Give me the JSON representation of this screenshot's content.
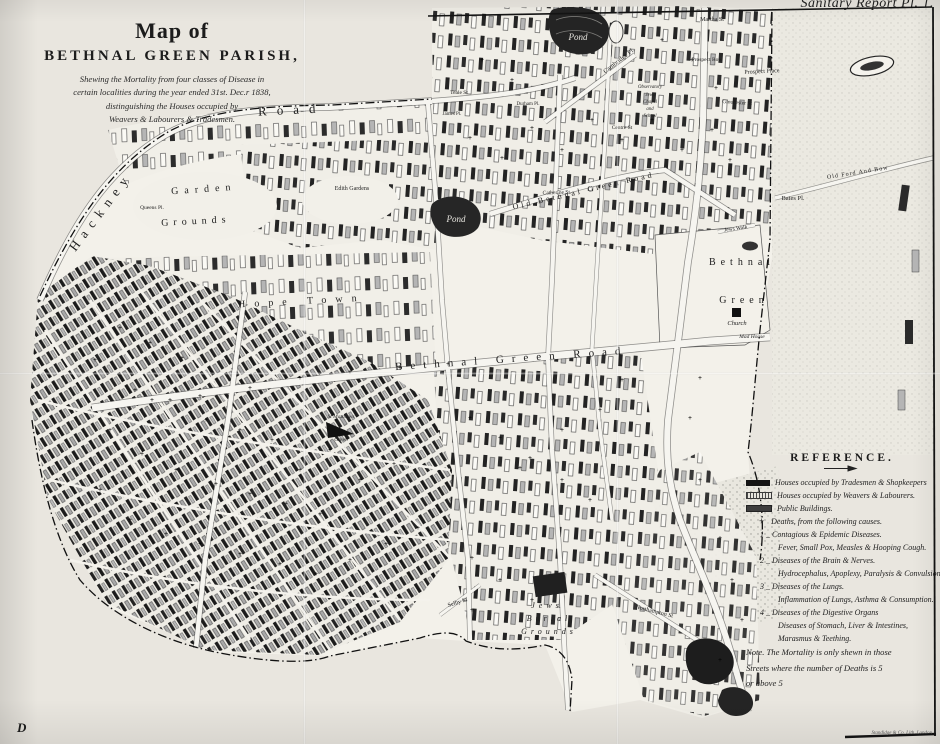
{
  "plate_label": "Sanitary Report Pl. 1.",
  "plate_letter": "D",
  "imprint": "Standidge & Co. Lith. London",
  "title_block": {
    "line1": "Map of",
    "line2": "BETHNAL GREEN PARISH,",
    "subtitle": [
      "Shewing the Mortality from four classes of Disease in",
      "certain localities during the year ended 31st. Dec.r 1838,",
      "distinguishing the Houses occupied by",
      "Weavers & Labourers & Tradesmen."
    ]
  },
  "reference": {
    "heading": "REFERENCE.",
    "rows": [
      {
        "type": "swatch",
        "swatch": "tradesmen",
        "text": "Houses occupied by Tradesmen & Shopkeepers"
      },
      {
        "type": "swatch",
        "swatch": "weavers",
        "text": "Houses occupied by Weavers & Labourers."
      },
      {
        "type": "swatch",
        "swatch": "public",
        "text": "Public Buildings."
      },
      {
        "type": "plus",
        "text": "Deaths, from the following causes."
      },
      {
        "type": "cause",
        "text": "1 _ Contagious & Epidemic Diseases."
      },
      {
        "type": "detail",
        "text": "Fever, Small Pox, Measles & Hooping Cough."
      },
      {
        "type": "cause",
        "text": "2 _ Diseases of the Brain & Nerves."
      },
      {
        "type": "detail",
        "text": "Hydrocephalus, Apoplexy, Paralysis & Convulsions."
      },
      {
        "type": "cause",
        "text": "3 _ Diseases of the Lungs."
      },
      {
        "type": "detail",
        "text": "Inflammation of Lungs, Asthma & Consumption."
      },
      {
        "type": "cause",
        "text": "4 _ Diseases of the Digestive Organs"
      },
      {
        "type": "detail",
        "text": "Diseases of Stomach, Liver & Intestines,"
      },
      {
        "type": "detail",
        "text": "Marasmus & Teething."
      },
      {
        "type": "note",
        "text": "Note. The Mortality is only shewn in those"
      },
      {
        "type": "note",
        "text": "Streets where the number of Deaths is 5"
      },
      {
        "type": "note",
        "text": "or above 5"
      }
    ]
  },
  "map": {
    "labels": [
      {
        "t": "Hackney",
        "x": 104,
        "y": 214,
        "fs": 13,
        "rot": -53,
        "ls": 7
      },
      {
        "t": "Road",
        "x": 292,
        "y": 114,
        "fs": 13,
        "rot": -3,
        "ls": 10
      },
      {
        "t": "Garden",
        "x": 204,
        "y": 192,
        "fs": 10,
        "rot": -4,
        "ls": 6
      },
      {
        "t": "Grounds",
        "x": 196,
        "y": 224,
        "fs": 10,
        "rot": -3,
        "ls": 5
      },
      {
        "t": "Queens Pl.",
        "x": 152,
        "y": 209,
        "fs": 5.5
      },
      {
        "t": "Edith Gardens",
        "x": 352,
        "y": 190,
        "fs": 6
      },
      {
        "t": "Hope Town",
        "x": 302,
        "y": 304,
        "fs": 10,
        "rot": -3,
        "ls": 9
      },
      {
        "t": "Old Bethnal Green Road",
        "x": 584,
        "y": 193,
        "fs": 8,
        "rot": -13,
        "ls": 3
      },
      {
        "t": "Bethnal Green Road",
        "x": 512,
        "y": 362,
        "fs": 11,
        "rot": -4,
        "ls": 8
      },
      {
        "t": "Bethnal",
        "x": 742,
        "y": 265,
        "fs": 10,
        "ls": 5
      },
      {
        "t": "Green",
        "x": 744,
        "y": 303,
        "fs": 10,
        "ls": 5
      },
      {
        "t": "Church",
        "x": 737,
        "y": 325,
        "fs": 6.5,
        "it": 1
      },
      {
        "t": "Mad House",
        "x": 752,
        "y": 338,
        "fs": 5.5,
        "it": 1
      },
      {
        "t": "Jews Walk",
        "x": 736,
        "y": 230,
        "fs": 5.5,
        "rot": -8
      },
      {
        "t": "Pond",
        "x": 578,
        "y": 40,
        "fs": 9,
        "it": 1,
        "col": "#e8e6e0"
      },
      {
        "t": "Pond",
        "x": 456,
        "y": 222,
        "fs": 9,
        "it": 1,
        "col": "#e8e6e0"
      },
      {
        "t": "Martha St",
        "x": 712,
        "y": 21,
        "fs": 6
      },
      {
        "t": "Prospect Row",
        "x": 707,
        "y": 61,
        "fs": 5.5
      },
      {
        "t": "Prospect Place",
        "x": 762,
        "y": 73,
        "fs": 6,
        "rot": -3
      },
      {
        "t": "Cambridge Pl.",
        "x": 620,
        "y": 62,
        "fs": 6.5,
        "rot": -38
      },
      {
        "t": "Gloucester St",
        "x": 737,
        "y": 104,
        "fs": 5.5,
        "rot": 4
      },
      {
        "t": "Observatory",
        "x": 650,
        "y": 88,
        "fs": 4.8,
        "it": 1
      },
      {
        "t": "Jews",
        "x": 650,
        "y": 96,
        "fs": 4.8,
        "it": 1
      },
      {
        "t": "Chapel",
        "x": 650,
        "y": 103,
        "fs": 4.8,
        "it": 1
      },
      {
        "t": "and",
        "x": 650,
        "y": 110,
        "fs": 4.8,
        "it": 1
      },
      {
        "t": "School",
        "x": 650,
        "y": 117,
        "fs": 4.8,
        "it": 1
      },
      {
        "t": "Bates Pl.",
        "x": 793,
        "y": 200,
        "fs": 6.5
      },
      {
        "t": "Old Ford And Bow",
        "x": 858,
        "y": 174,
        "fs": 6,
        "rot": -9,
        "ls": 1
      },
      {
        "t": "Centre St",
        "x": 622,
        "y": 129,
        "fs": 5.5
      },
      {
        "t": "Teale St",
        "x": 459,
        "y": 94,
        "fs": 5.5
      },
      {
        "t": "Durham Pl.",
        "x": 528,
        "y": 105,
        "fs": 5
      },
      {
        "t": "James Pl.",
        "x": 452,
        "y": 115,
        "fs": 5
      },
      {
        "t": "Catherine St.",
        "x": 557,
        "y": 194,
        "fs": 5.5,
        "rot": -2
      },
      {
        "t": "St Matthews",
        "x": 341,
        "y": 418,
        "fs": 5.5,
        "it": 1
      },
      {
        "t": "Green",
        "x": 341,
        "y": 441,
        "fs": 5.5,
        "it": 1
      },
      {
        "t": "Jews",
        "x": 547,
        "y": 608,
        "fs": 8,
        "ls": 4,
        "it": 1
      },
      {
        "t": "Burial",
        "x": 549,
        "y": 621,
        "fs": 8,
        "ls": 4,
        "it": 1
      },
      {
        "t": "Grounds",
        "x": 549,
        "y": 634,
        "fs": 8,
        "ls": 4,
        "it": 1
      },
      {
        "t": "Northampton St",
        "x": 654,
        "y": 613,
        "fs": 6,
        "rot": 14
      },
      {
        "t": "Selby St",
        "x": 458,
        "y": 604,
        "fs": 6,
        "rot": -18
      }
    ],
    "death_markers": [
      [
        120,
        330
      ],
      [
        150,
        345
      ],
      [
        182,
        360
      ],
      [
        212,
        376
      ],
      [
        95,
        362
      ],
      [
        135,
        392
      ],
      [
        170,
        402
      ],
      [
        206,
        422
      ],
      [
        240,
        432
      ],
      [
        272,
        442
      ],
      [
        110,
        432
      ],
      [
        142,
        456
      ],
      [
        176,
        472
      ],
      [
        216,
        486
      ],
      [
        250,
        496
      ],
      [
        286,
        506
      ],
      [
        320,
        516
      ],
      [
        100,
        492
      ],
      [
        130,
        522
      ],
      [
        166,
        536
      ],
      [
        200,
        546
      ],
      [
        240,
        556
      ],
      [
        280,
        566
      ],
      [
        316,
        576
      ],
      [
        350,
        562
      ],
      [
        386,
        546
      ],
      [
        418,
        530
      ],
      [
        360,
        482
      ],
      [
        394,
        466
      ],
      [
        330,
        452
      ],
      [
        300,
        472
      ],
      [
        250,
        390
      ],
      [
        200,
        398
      ],
      [
        152,
        402
      ],
      [
        300,
        380
      ],
      [
        350,
        374
      ],
      [
        400,
        370
      ],
      [
        448,
        366
      ],
      [
        470,
        420
      ],
      [
        500,
        440
      ],
      [
        530,
        460
      ],
      [
        562,
        482
      ],
      [
        590,
        502
      ],
      [
        472,
        560
      ],
      [
        500,
        582
      ],
      [
        532,
        602
      ],
      [
        472,
        612
      ],
      [
        520,
        470
      ],
      [
        562,
        432
      ],
      [
        600,
        412
      ],
      [
        622,
        382
      ],
      [
        470,
        140
      ],
      [
        502,
        160
      ],
      [
        532,
        130
      ],
      [
        562,
        152
      ],
      [
        592,
        122
      ],
      [
        622,
        142
      ],
      [
        652,
        122
      ],
      [
        682,
        152
      ],
      [
        712,
        132
      ],
      [
        730,
        162
      ],
      [
        716,
        90
      ],
      [
        692,
        62
      ],
      [
        662,
        42
      ],
      [
        482,
        62
      ],
      [
        512,
        82
      ],
      [
        700,
        380
      ],
      [
        690,
        420
      ],
      [
        700,
        482
      ],
      [
        720,
        540
      ],
      [
        732,
        582
      ],
      [
        742,
        622
      ],
      [
        720,
        662
      ]
    ]
  }
}
